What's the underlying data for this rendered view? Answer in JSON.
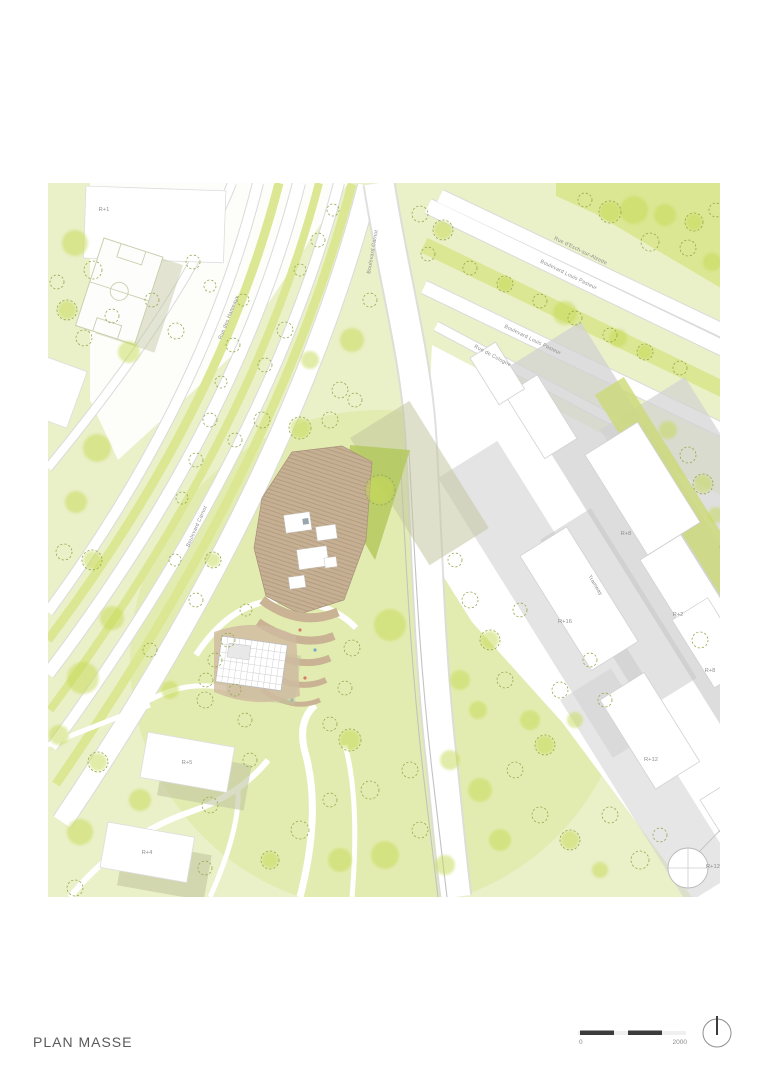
{
  "page": {
    "title": "PLAN MASSE"
  },
  "scale_bar": {
    "label_start": "0",
    "label_end": "2000"
  },
  "icons": {
    "north": "north-arrow"
  },
  "map": {
    "street_labels": [
      {
        "text": "Boulevard Carnot"
      },
      {
        "text": "Rue d'Esch-sur-Alzette"
      },
      {
        "text": "Boulevard Louis Pasteur"
      },
      {
        "text": "Boulevard Louis Pasteur"
      },
      {
        "text": "Rue de Cologne"
      },
      {
        "text": "Rue des Hameaux"
      },
      {
        "text": "Boulevard Carnot"
      },
      {
        "text": "Tramway"
      }
    ],
    "building_labels": [
      {
        "text": "R+1"
      },
      {
        "text": "R+8"
      },
      {
        "text": "R+16"
      },
      {
        "text": "R+2"
      },
      {
        "text": "R+8"
      },
      {
        "text": "R+12"
      },
      {
        "text": "R+12"
      },
      {
        "text": "R+5"
      },
      {
        "text": "R+4"
      }
    ],
    "colors": {
      "park_green": "#eaf0c8",
      "accent_green": "#dbe792",
      "tree_green": "#c5da52",
      "tree_outline": "#93a84c",
      "lawn_green": "#ccd977",
      "project_tan": "#c3ad92",
      "project_tan_dark": "#a8907a",
      "shadow_gray": "#d2d2d2",
      "road_casing": "#dadada",
      "text_gray": "#8a8a8a",
      "title_gray": "#5a5a5a",
      "scale_dark": "#3c3c3c"
    }
  }
}
